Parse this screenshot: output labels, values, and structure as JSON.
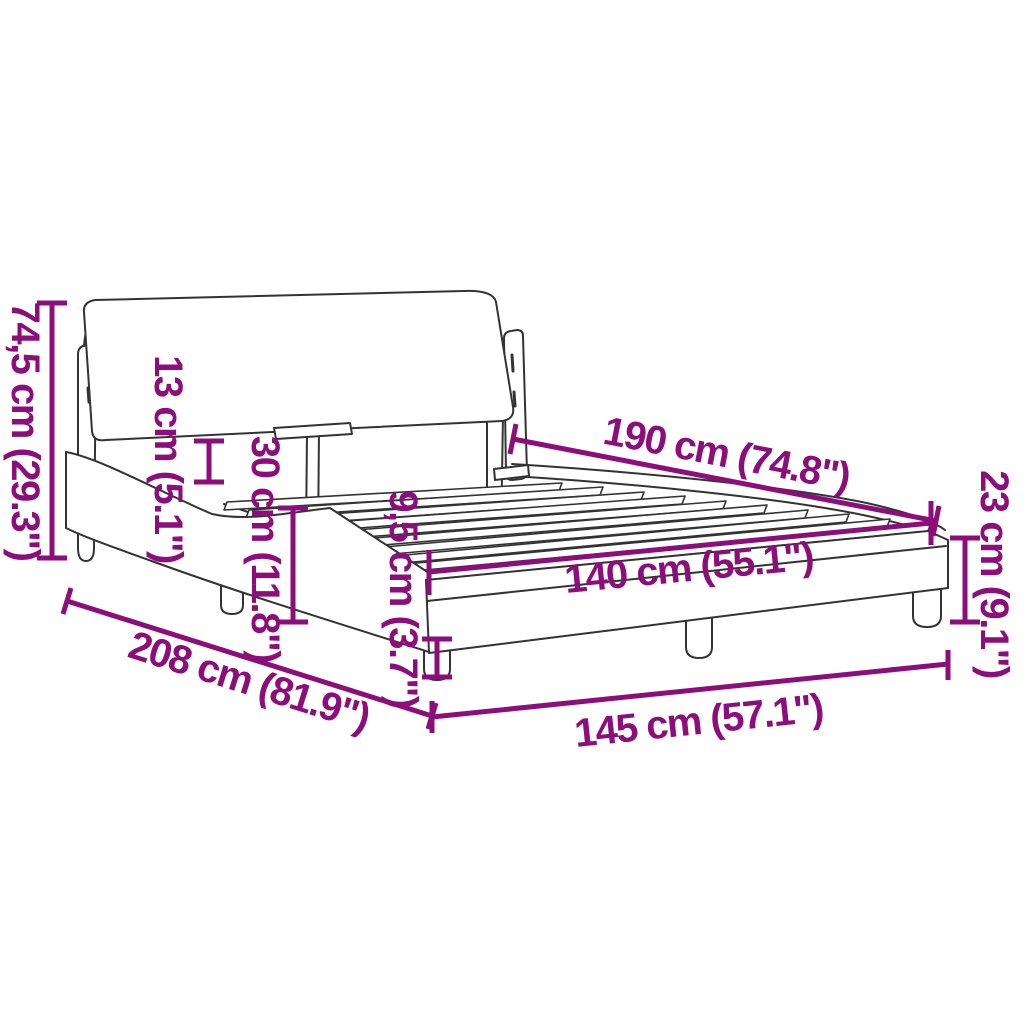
{
  "diagram": {
    "title": "bed-frame dimension diagram",
    "accent_color": "#8c0e7a",
    "line_color": "#333333",
    "background_color": "#ffffff",
    "dimensions": [
      {
        "name": "total-height",
        "label": "74,5 cm (29.3\")",
        "cm": "74,5",
        "inches": "29.3"
      },
      {
        "name": "headboard-depth",
        "label": "13 cm (5.1\")",
        "cm": "13",
        "inches": "5.1"
      },
      {
        "name": "headboard-drop",
        "label": "30 cm (11.8\")",
        "cm": "30",
        "inches": "11.8"
      },
      {
        "name": "slat-length",
        "label": "190 cm (74.8\")",
        "cm": "190",
        "inches": "74.8"
      },
      {
        "name": "slat-width",
        "label": "140 cm (55.1\")",
        "cm": "140",
        "inches": "55.1"
      },
      {
        "name": "leg-height",
        "label": "9,5 cm (3.7\")",
        "cm": "9,5",
        "inches": "3.7"
      },
      {
        "name": "frame-height",
        "label": "23 cm (9.1\")",
        "cm": "23",
        "inches": "9.1"
      },
      {
        "name": "total-length",
        "label": "208 cm (81.9\")",
        "cm": "208",
        "inches": "81.9"
      },
      {
        "name": "total-width",
        "label": "145 cm (57.1\")",
        "cm": "145",
        "inches": "57.1"
      }
    ]
  }
}
